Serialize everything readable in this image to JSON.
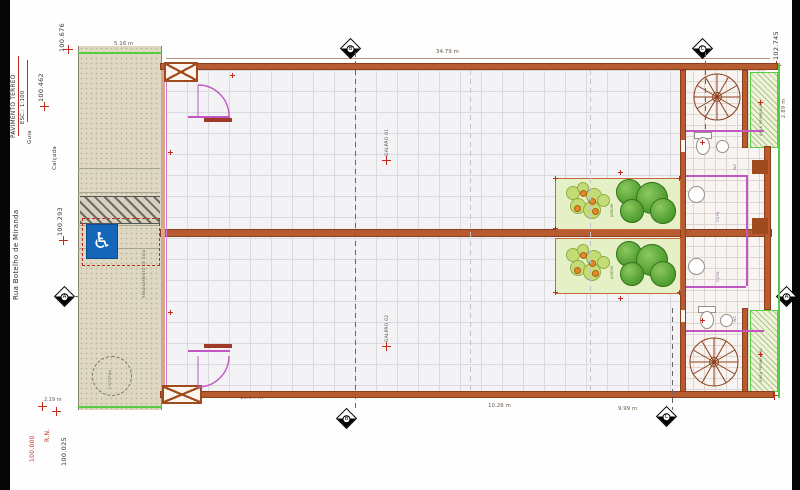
{
  "sheet": {
    "title": "PAVIMENTO TÉRREO",
    "scale": "ESC.: 1:100"
  },
  "street": {
    "name": "Rua Botelho de Miranda",
    "sidewalk": "Calçada",
    "curb": "Guia",
    "curb_cut": "REBAIXAMENTO DE GUIA",
    "cistern": "CISTERNA"
  },
  "levels": {
    "l_100_676": "100.676",
    "l_100_462": "100.462",
    "l_100_293": "100.293",
    "l_100_025": "100.025",
    "rn_label": "R.N.",
    "rn_value": "100.000",
    "l_102_745": "102.745",
    "l_102_481": "102.481"
  },
  "dims": {
    "d_5_16": "5.16 m",
    "d_34_79": "34.79 m",
    "d_2_89": "2.89 m",
    "d_2_19": "2.19 m",
    "d_19_94": "19.94 m",
    "d_10_26": "10.26 m",
    "d_9_99": "9.99 m",
    "d_2_59": "2.59"
  },
  "rooms": {
    "unit1": "GALPÃO 01",
    "unit2": "GALPÃO 02",
    "garden": "JARDIM",
    "permeable": "ÁREA PERMEÁVEL",
    "wc": "WC",
    "copa": "COPA"
  },
  "markers": {
    "a": "A",
    "b": "B",
    "c": "C"
  },
  "icons": {
    "wheelchair": "♿"
  },
  "colors": {
    "wall": "#b65c30",
    "wall_dark": "#8d3f1c",
    "magenta": "#c257c2",
    "property_green": "#55cc44",
    "marker_red": "#c22a1c",
    "accessibility_blue": "#1467b8"
  }
}
